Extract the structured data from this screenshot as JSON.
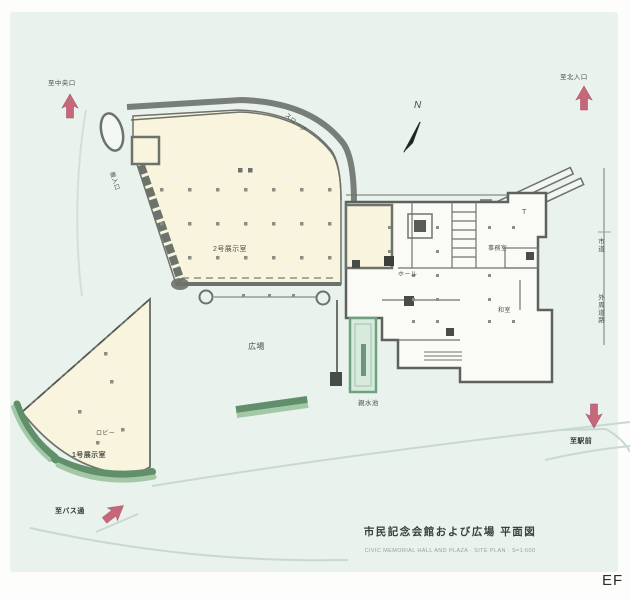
{
  "meta": {
    "corner_mark": "EF"
  },
  "colors": {
    "paper": "#e9f2ec",
    "margin": "#fdfdfb",
    "building_fill": "#f8f4de",
    "building_wall": "#6d726b",
    "floor_white": "#fafbf7",
    "hedge_dark": "#618f6b",
    "hedge_light": "#a3c8a6",
    "pond_fill": "#d7eadd",
    "pond_edge": "#6fa181",
    "pond_core": "#6e937e",
    "arrow_red": "#c04f66",
    "path_line": "#c9d9d0",
    "ink": "#4c514b"
  },
  "compass": {
    "label": "N"
  },
  "arrows": {
    "top_left": {
      "label": "至中央口"
    },
    "top_right": {
      "label": "至北入口"
    },
    "bottom_right": {
      "label": "至駅前"
    },
    "bottom_left": {
      "label": "至バス通"
    }
  },
  "roads": {
    "upper": "市道",
    "lower": "外周道路"
  },
  "site_labels": {
    "plaza": "広場",
    "pond": "親水池",
    "slope": "スロープ",
    "service": "搬入口"
  },
  "buildings": {
    "hall2": {
      "name": "2号展示室"
    },
    "hall1": {
      "name": "1号展示室",
      "lobby": "ロビー"
    },
    "main": {
      "hall": "ホール",
      "office": "事務室",
      "washitsu": "和室",
      "t_mark": "T"
    }
  },
  "caption": {
    "title": "市民記念会館および広場 平面図",
    "subtitle": "CIVIC MEMORIAL HALL AND PLAZA · SITE PLAN · S=1:600"
  }
}
